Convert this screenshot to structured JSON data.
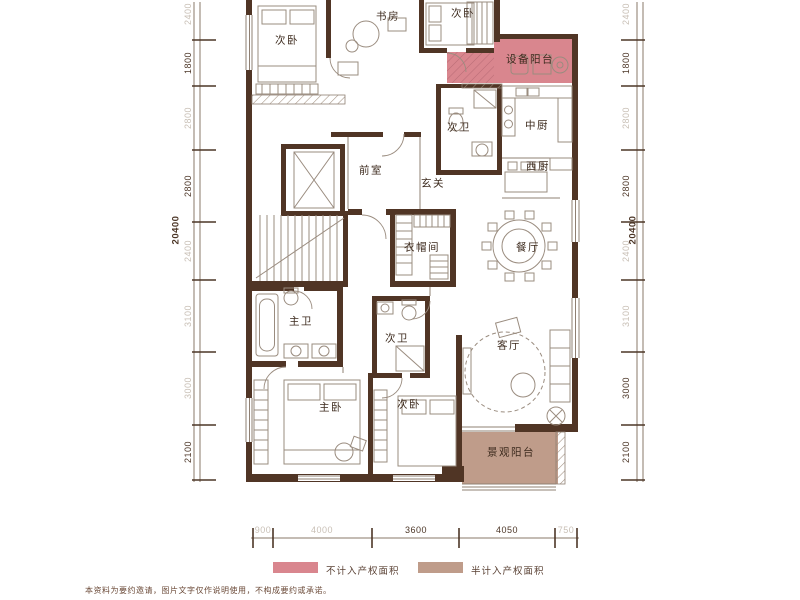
{
  "rooms": [
    {
      "id": "bedroom-top-left",
      "label": "次卧"
    },
    {
      "id": "study",
      "label": "书房"
    },
    {
      "id": "bedroom-top-right",
      "label": "次卧"
    },
    {
      "id": "equipment-balcony",
      "label": "设备阳台"
    },
    {
      "id": "bath-upper",
      "label": "次卫"
    },
    {
      "id": "kitchen-chinese",
      "label": "中厨"
    },
    {
      "id": "kitchen-western",
      "label": "西厨"
    },
    {
      "id": "front-room",
      "label": "前室"
    },
    {
      "id": "foyer",
      "label": "玄关"
    },
    {
      "id": "cloakroom",
      "label": "衣帽间"
    },
    {
      "id": "dining-room",
      "label": "餐厅"
    },
    {
      "id": "bath-master",
      "label": "主卫"
    },
    {
      "id": "bath-secondary",
      "label": "次卫"
    },
    {
      "id": "living-room",
      "label": "客厅"
    },
    {
      "id": "bedroom-master",
      "label": "主卧"
    },
    {
      "id": "bedroom-lower",
      "label": "次卧"
    },
    {
      "id": "view-balcony",
      "label": "景观阳台"
    }
  ],
  "dimensions": {
    "left": {
      "overall": "20400",
      "segments": [
        "2400",
        "1800",
        "2800",
        "2800",
        "2400",
        "3100",
        "3000",
        "2100"
      ]
    },
    "right": {
      "overall": "20400",
      "segments": [
        "2400",
        "1800",
        "2800",
        "2800",
        "2400",
        "3100",
        "3000",
        "2100"
      ]
    },
    "bottom": {
      "segments": [
        "900",
        "4000",
        "3600",
        "4050",
        "750"
      ]
    }
  },
  "legend": {
    "items": [
      {
        "label": "不计入产权面积",
        "color": "#d9868e"
      },
      {
        "label": "半计入产权面积",
        "color": "#bf9c8a"
      }
    ]
  },
  "disclaimer": "本资料为要约邀请，图片文字仅作说明使用，不构成要约或承诺。",
  "colors": {
    "wall": "#503525",
    "highlight_no_property": "#d9868e",
    "highlight_half_property": "#bf9c8a",
    "dim_dark": "#4c3627",
    "dim_light": "#c8bfb5"
  }
}
